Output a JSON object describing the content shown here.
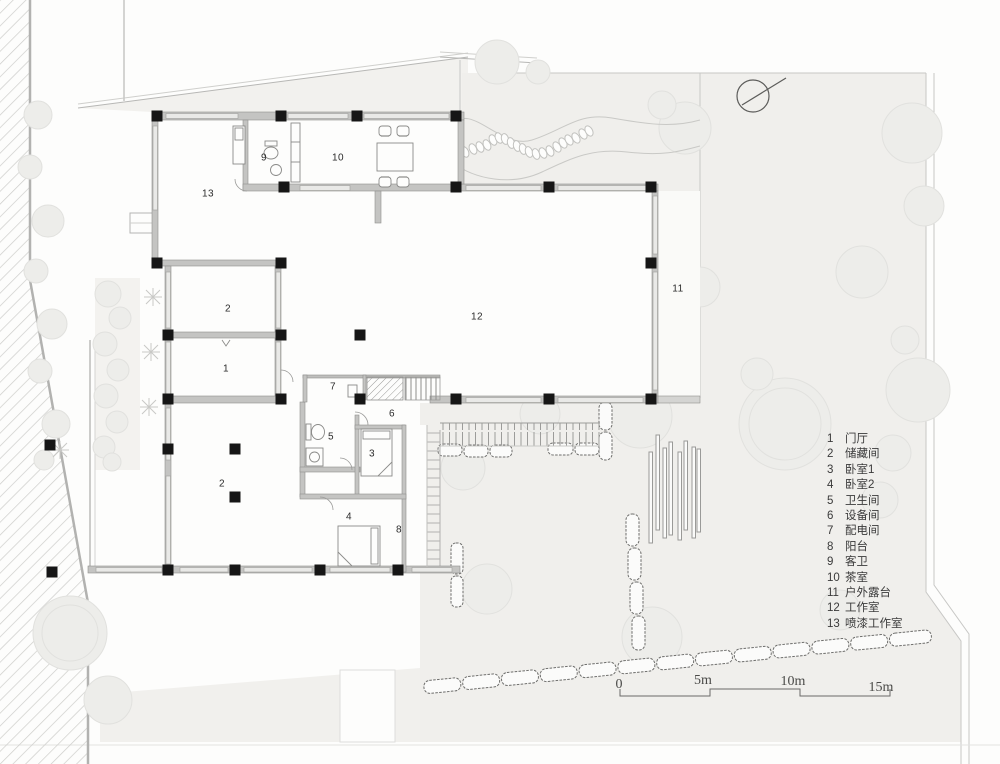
{
  "legend": {
    "items": [
      {
        "num": "1",
        "label": "门厅"
      },
      {
        "num": "2",
        "label": "储藏间"
      },
      {
        "num": "3",
        "label": "卧室1"
      },
      {
        "num": "4",
        "label": "卧室2"
      },
      {
        "num": "5",
        "label": "卫生间"
      },
      {
        "num": "6",
        "label": "设备间"
      },
      {
        "num": "7",
        "label": "配电间"
      },
      {
        "num": "8",
        "label": "阳台"
      },
      {
        "num": "9",
        "label": "客卫"
      },
      {
        "num": "10",
        "label": "茶室"
      },
      {
        "num": "11",
        "label": "户外露台"
      },
      {
        "num": "12",
        "label": "工作室"
      },
      {
        "num": "13",
        "label": "喷漆工作室"
      }
    ]
  },
  "plan": {
    "room_labels": [
      {
        "num": "9",
        "x": 264,
        "y": 158
      },
      {
        "num": "10",
        "x": 338,
        "y": 158
      },
      {
        "num": "13",
        "x": 208,
        "y": 194
      },
      {
        "num": "2",
        "x": 228,
        "y": 309
      },
      {
        "num": "1",
        "x": 226,
        "y": 369
      },
      {
        "num": "12",
        "x": 477,
        "y": 317
      },
      {
        "num": "11",
        "x": 678,
        "y": 289
      },
      {
        "num": "7",
        "x": 333,
        "y": 387
      },
      {
        "num": "6",
        "x": 392,
        "y": 414
      },
      {
        "num": "5",
        "x": 331,
        "y": 437
      },
      {
        "num": "3",
        "x": 372,
        "y": 454
      },
      {
        "num": "2",
        "x": 222,
        "y": 484
      },
      {
        "num": "4",
        "x": 349,
        "y": 517
      },
      {
        "num": "8",
        "x": 399,
        "y": 530
      }
    ]
  },
  "scale_bar": {
    "ticks": [
      {
        "text": "0",
        "x": 619,
        "y": 677
      },
      {
        "text": "5m",
        "x": 703,
        "y": 673
      },
      {
        "text": "10m",
        "x": 793,
        "y": 674
      },
      {
        "text": "15m",
        "x": 881,
        "y": 680
      }
    ]
  },
  "colors": {
    "column": "#161616",
    "wall": "#c4c4c2",
    "window": "#e9e9e7",
    "garden": "#f0efec",
    "hedge_line": "#6e6e6c",
    "paper": "#fdfdfc"
  }
}
